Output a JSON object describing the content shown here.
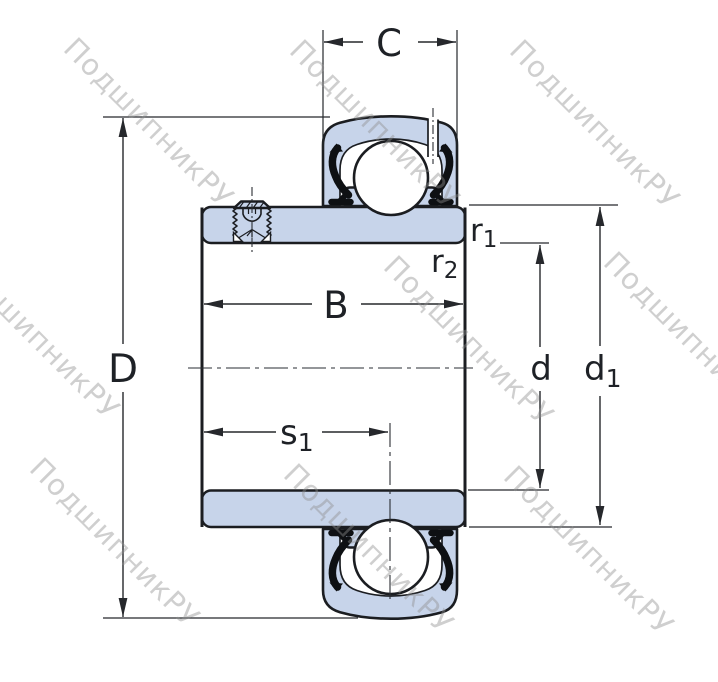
{
  "watermark": {
    "text": "ПодшипникРУ"
  },
  "colors": {
    "ring_fill": "#c7d4ea",
    "outline": "#1b1d21",
    "seal": "#0e1013",
    "dimension_line": "#26282c",
    "watermark_gray": "#8f8f8f",
    "background": "#ffffff"
  },
  "labels": {
    "C": {
      "text": "C"
    },
    "D": {
      "text": "D"
    },
    "B": {
      "text": "B"
    },
    "d": {
      "text": "d"
    },
    "s1": {
      "base": "s",
      "sub": "1"
    },
    "r1": {
      "base": "r",
      "sub": "1"
    },
    "r2": {
      "base": "r",
      "sub": "2"
    },
    "d1": {
      "base": "d",
      "sub": "1"
    }
  }
}
